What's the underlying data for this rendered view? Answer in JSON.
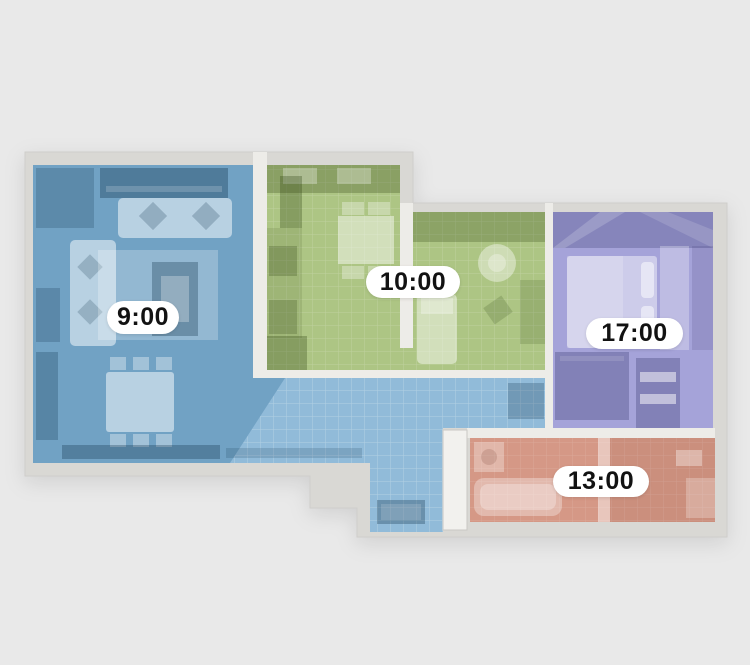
{
  "palette": {
    "background": "#e9e9e9",
    "outer_wall": "#d9d8d4",
    "inner_wall": "#edece8",
    "door": "#f2f1ee",
    "label_bg": "#ffffff",
    "label_text": "#121212"
  },
  "rooms": [
    {
      "id": "living-room",
      "time": "9:00",
      "color": "#7fb0d3"
    },
    {
      "id": "kitchen",
      "time": "10:00",
      "color": "#adc584"
    },
    {
      "id": "bedroom",
      "time": "17:00",
      "color": "#a5a3d9"
    },
    {
      "id": "bathroom",
      "time": "13:00",
      "color": "#d59886"
    }
  ]
}
